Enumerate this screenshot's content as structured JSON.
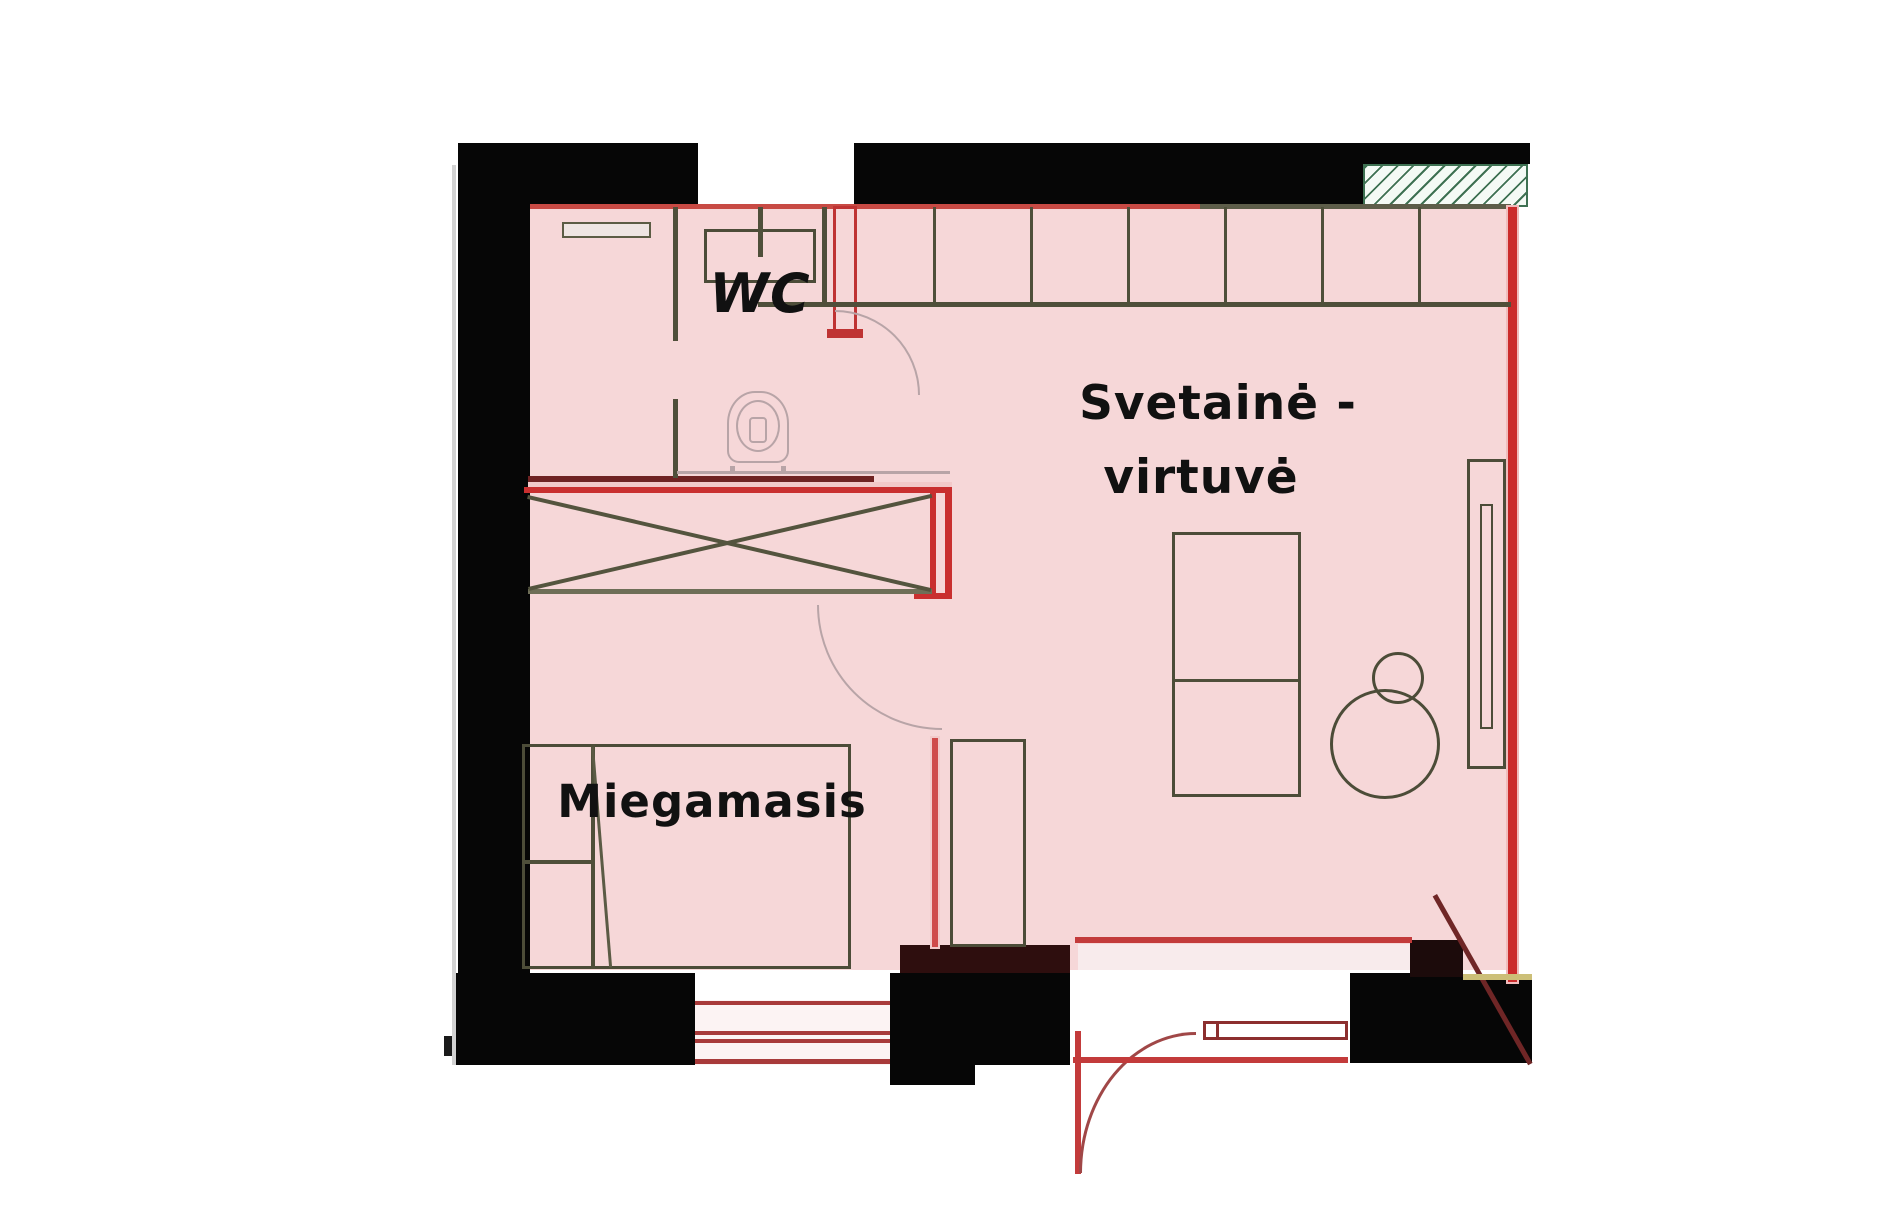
{
  "plan_title": "apartment-floor-plan",
  "rooms": {
    "wc": {
      "label": "WC"
    },
    "living_kitchen": {
      "label_line1": "Svetainė -",
      "label_line2": "virtuvė"
    },
    "bedroom": {
      "label": "Miegamasis"
    }
  },
  "colors": {
    "floor_fill": "#f6d7d8",
    "existing_wall_black": "#060606",
    "new_wall_red": "#c92f2f",
    "dark_red_line": "#6f2222",
    "fixture_olive": "#4c4c38",
    "door_arc_gray": "#b8a4a7",
    "hatch_green": "#3e7152",
    "window_red": "#a83a3a",
    "threshold_yellow": "#ccbf78"
  }
}
